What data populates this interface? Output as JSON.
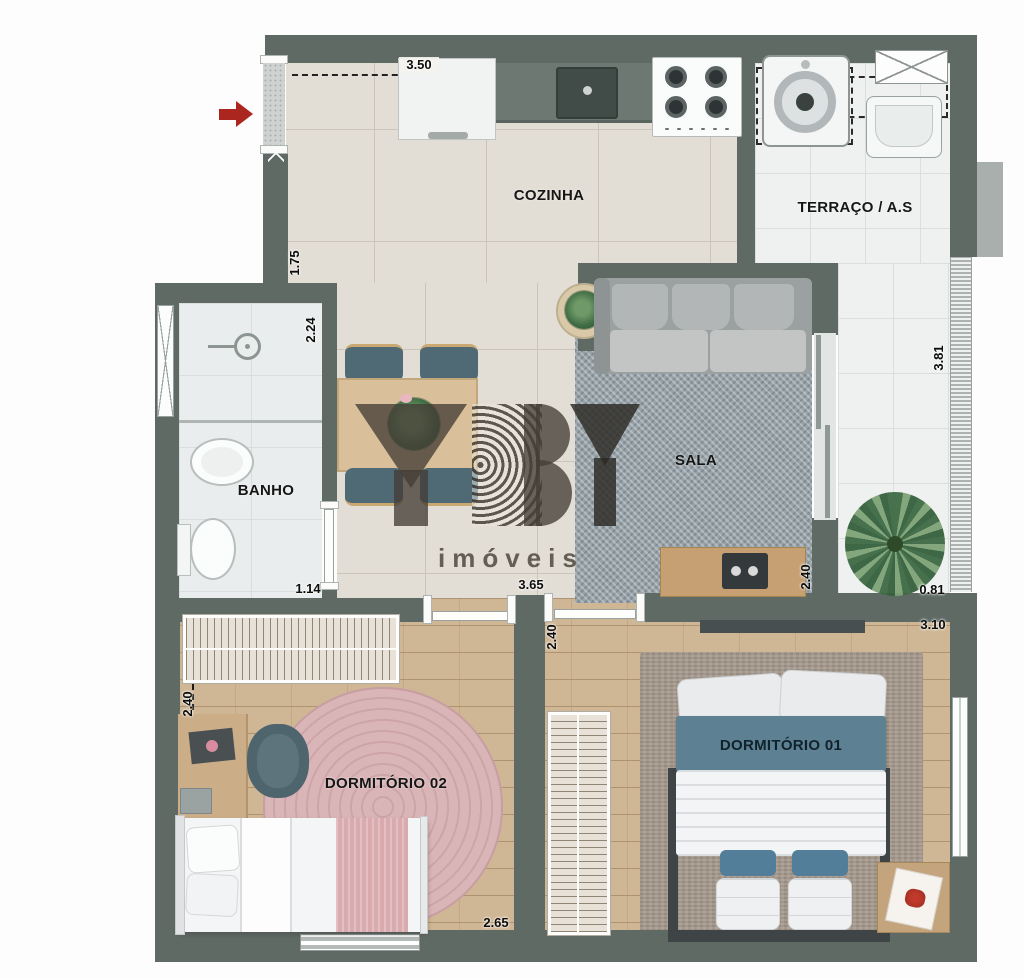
{
  "plan": {
    "brand": {
      "logo_text": "YBY",
      "subtitle": "imóveis"
    },
    "rooms": {
      "cozinha": {
        "label": "COZINHA"
      },
      "terraco": {
        "label": "TERRAÇO / A.S"
      },
      "banho": {
        "label": "BANHO"
      },
      "sala": {
        "label": "SALA"
      },
      "dormitorio1": {
        "label": "DORMITÓRIO 01"
      },
      "dormitorio2": {
        "label": "DORMITÓRIO 02"
      }
    },
    "dimensions": {
      "cozinha_width": "3.50",
      "entry_wall": "1.75",
      "banho_length": "2.24",
      "banho_width": "1.14",
      "sala_width": "3.65",
      "sala_depth": "2.40",
      "varanda_length": "3.81",
      "varanda_width": "0.81",
      "hall_depth": "2.40",
      "dormitorio1_width": "3.10",
      "dormitorio2_depth": "2.40",
      "dormitorio2_width": "2.65"
    },
    "colors": {
      "wall": "#5f6a65",
      "arrow_red": "#aa261f",
      "bed_accent": "#5d8093",
      "chair_teal": "#4f6a75",
      "rug_pink": "#d5abae"
    }
  }
}
